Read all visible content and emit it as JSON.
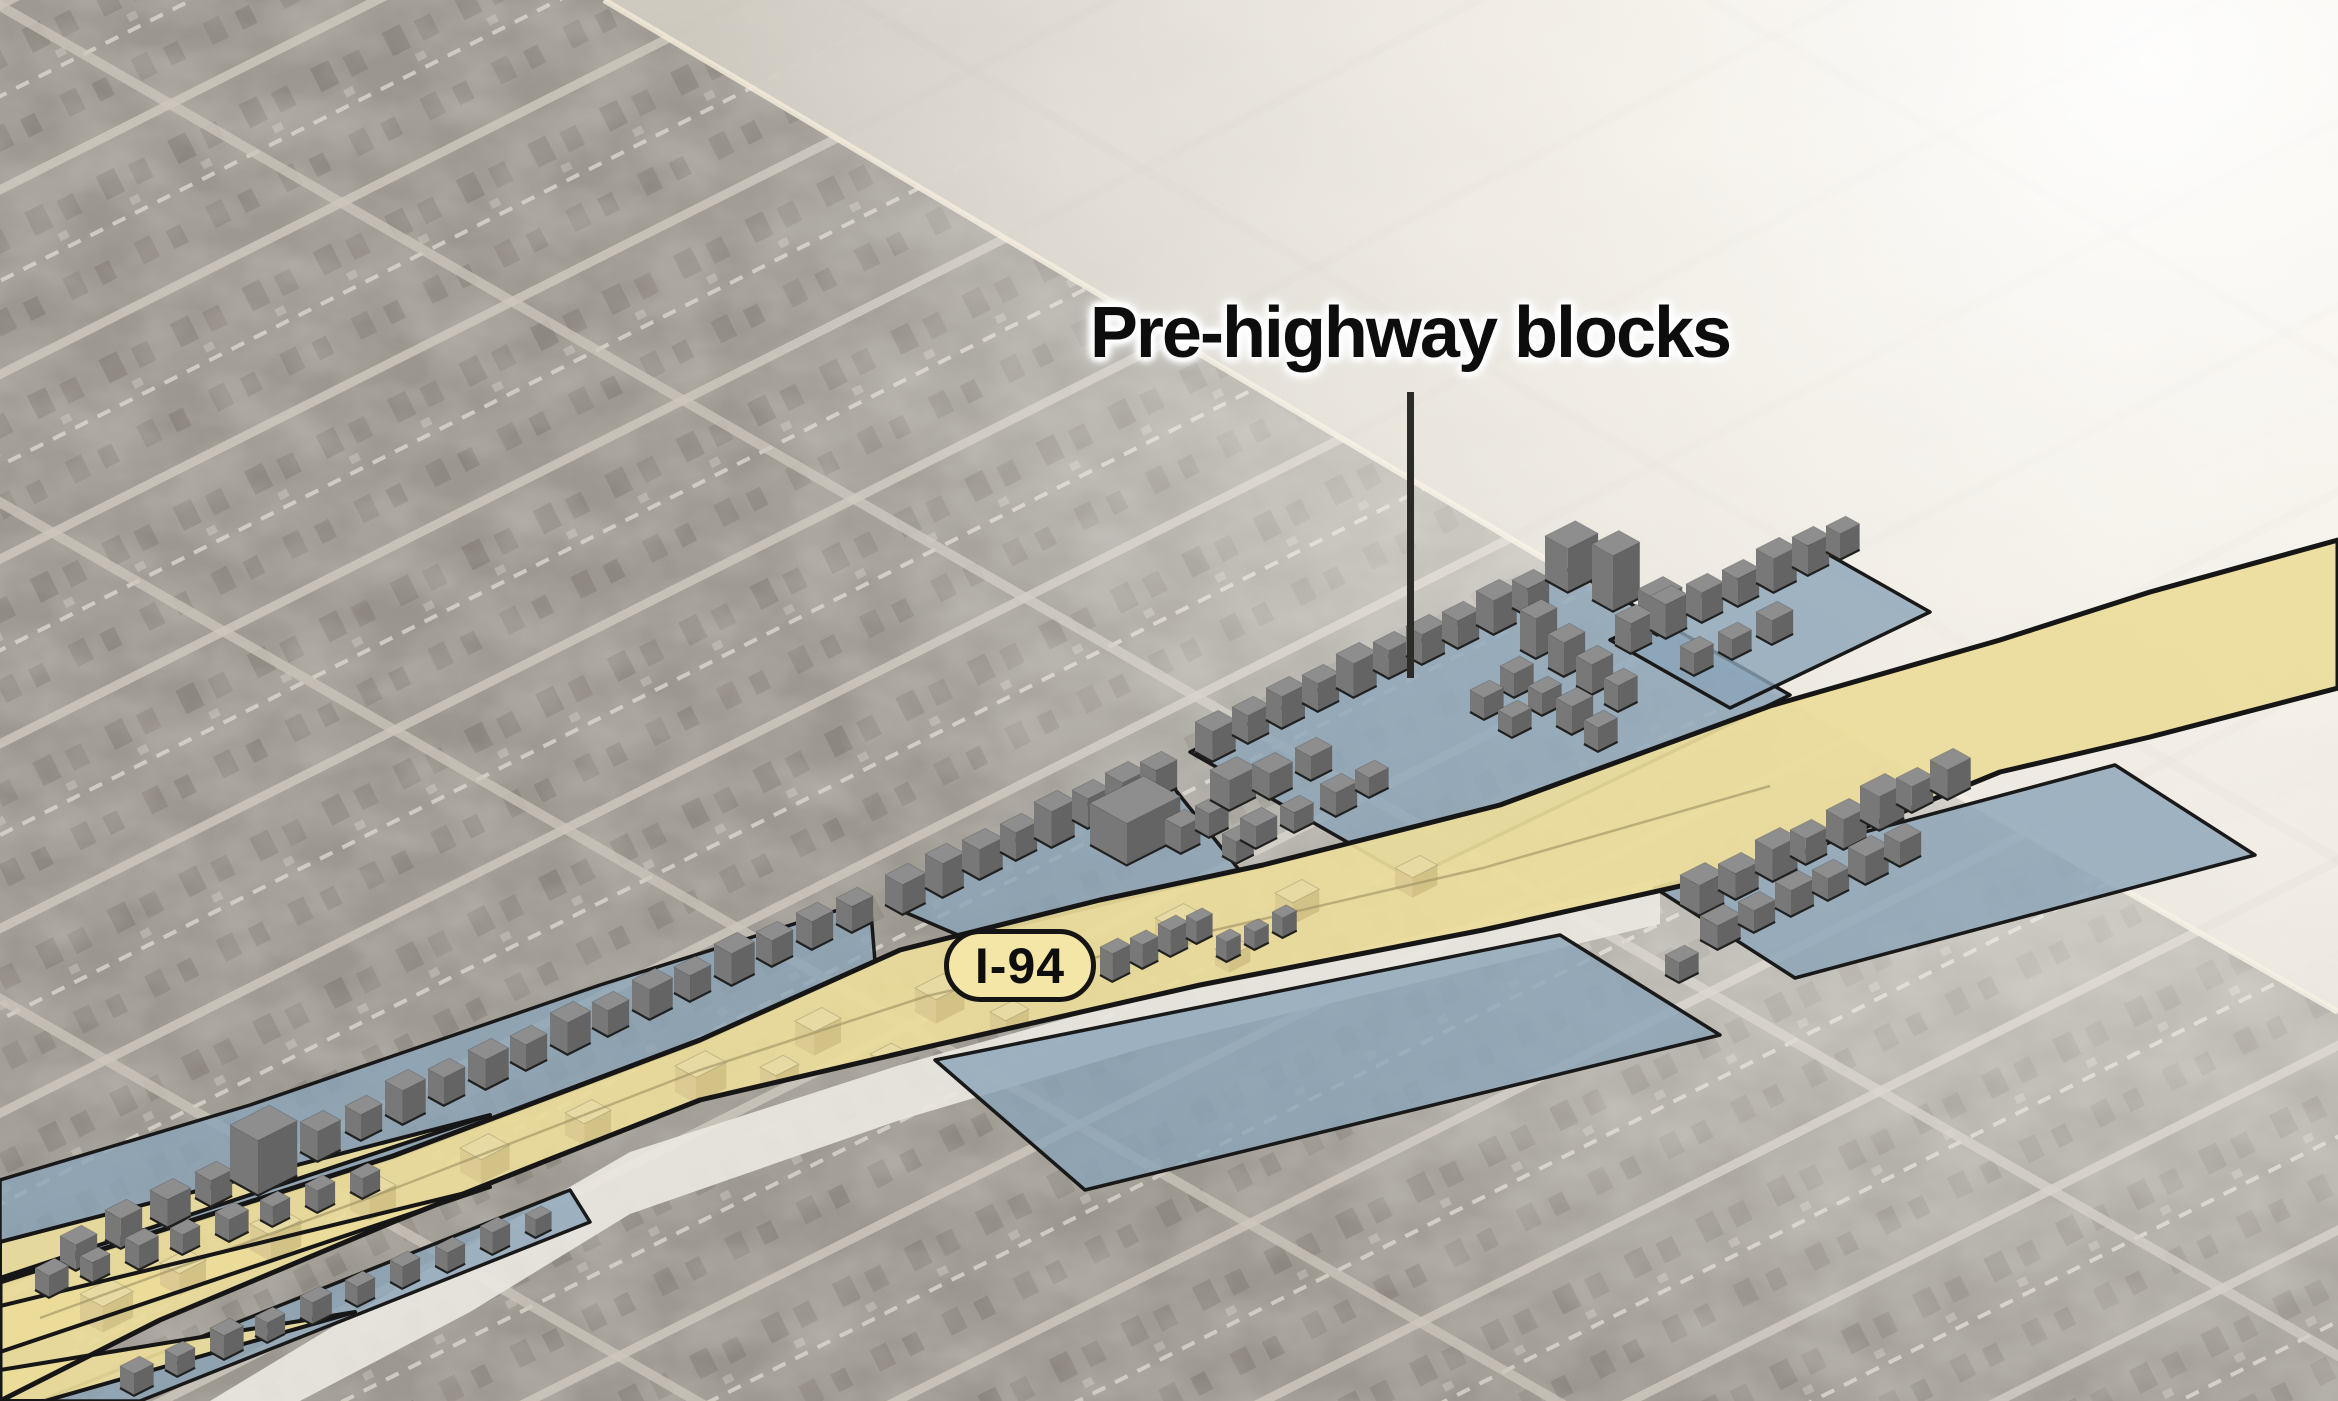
{
  "scene": {
    "width": 2338,
    "height": 1401
  },
  "annotation": {
    "label": "Pre-highway blocks"
  },
  "badge": {
    "label": "I-94"
  },
  "colors": {
    "highway_fill": "#ecdc9a",
    "highway_outline": "#161616",
    "block_overlay": "#8ba4b8",
    "block_outline": "#191919",
    "building_top": "#8e8e8e",
    "building_side": "#787878",
    "building_front": "#646464",
    "building_edge": "#20201f",
    "ghost_top": "#e8daa3",
    "ghost_side": "#dbcb92",
    "ghost_front": "#d2c286",
    "white_road": "#eae7e1",
    "aerial_dark": "#99948c",
    "aerial_light": "#e8e2d8",
    "boundary_road": "#f2e9d7",
    "centerline": "#9b8f63",
    "label_color": "#0d0d0d",
    "badge_fill": "#f4e6a6",
    "leader": "#2d2b28"
  },
  "map": {
    "dark_region": [
      [
        0,
        0
      ],
      [
        604,
        0
      ],
      [
        1560,
        568
      ],
      [
        2338,
        1012
      ],
      [
        2338,
        1401
      ],
      [
        0,
        1401
      ]
    ],
    "boundary_road": [
      [
        604,
        0
      ],
      [
        1560,
        568
      ],
      [
        2338,
        1012
      ]
    ],
    "white_road": [
      [
        210,
        1401
      ],
      [
        430,
        1268
      ],
      [
        630,
        1152
      ],
      [
        900,
        1065
      ],
      [
        1150,
        995
      ],
      [
        1420,
        935
      ],
      [
        1660,
        878
      ],
      [
        1660,
        924
      ],
      [
        1420,
        982
      ],
      [
        1150,
        1046
      ],
      [
        900,
        1120
      ],
      [
        630,
        1214
      ],
      [
        470,
        1312
      ],
      [
        300,
        1401
      ]
    ],
    "highway_top": [
      [
        0,
        1282
      ],
      [
        393,
        1156
      ],
      [
        700,
        1040
      ],
      [
        900,
        950
      ],
      [
        1100,
        900
      ],
      [
        1263,
        865
      ],
      [
        1500,
        805
      ],
      [
        1770,
        706
      ],
      [
        2000,
        640
      ],
      [
        2150,
        592
      ],
      [
        2338,
        540
      ]
    ],
    "highway_bottom": [
      [
        2338,
        688
      ],
      [
        2150,
        737
      ],
      [
        2000,
        772
      ],
      [
        1770,
        866
      ],
      [
        1483,
        930
      ],
      [
        1200,
        985
      ],
      [
        927,
        1047
      ],
      [
        700,
        1100
      ],
      [
        553,
        1158
      ],
      [
        393,
        1222
      ],
      [
        160,
        1320
      ],
      [
        0,
        1401
      ]
    ],
    "ramps": [
      [
        [
          0,
          1242
        ],
        [
          490,
          1115
        ],
        [
          0,
          1278
        ]
      ],
      [
        [
          490,
          1187
        ],
        [
          0,
          1306
        ],
        [
          0,
          1352
        ]
      ],
      [
        [
          355,
          1312
        ],
        [
          0,
          1370
        ],
        [
          0,
          1401
        ],
        [
          45,
          1401
        ]
      ]
    ],
    "centerline": [
      [
        40,
        1318
      ],
      [
        393,
        1189
      ],
      [
        700,
        1070
      ],
      [
        927,
        996
      ],
      [
        1263,
        919
      ],
      [
        1483,
        868
      ],
      [
        1770,
        786
      ]
    ],
    "blue_blocks": [
      [
        [
          0,
          1180
        ],
        [
          250,
          1105
        ],
        [
          600,
          985
        ],
        [
          870,
          900
        ],
        [
          875,
          962
        ],
        [
          700,
          1042
        ],
        [
          393,
          1158
        ],
        [
          0,
          1284
        ]
      ],
      [
        [
          888,
          905
        ],
        [
          1158,
          768
        ],
        [
          1240,
          871
        ],
        [
          965,
          938
        ]
      ],
      [
        [
          1190,
          752
        ],
        [
          1570,
          569
        ],
        [
          1790,
          695
        ],
        [
          1410,
          878
        ]
      ],
      [
        [
          1610,
          640
        ],
        [
          1810,
          544
        ],
        [
          1930,
          612
        ],
        [
          1730,
          708
        ]
      ],
      [
        [
          40,
          1401
        ],
        [
          570,
          1190
        ],
        [
          590,
          1222
        ],
        [
          140,
          1401
        ]
      ],
      [
        [
          935,
          1060
        ],
        [
          1560,
          935
        ],
        [
          1720,
          1035
        ],
        [
          1085,
          1190
        ]
      ],
      [
        [
          1655,
          888
        ],
        [
          2115,
          765
        ],
        [
          2255,
          855
        ],
        [
          1795,
          978
        ]
      ]
    ],
    "ghost_buildings": [
      [
        80,
        1320,
        34,
        26,
        26
      ],
      [
        160,
        1285,
        30,
        22,
        22
      ],
      [
        250,
        1250,
        34,
        24,
        26
      ],
      [
        350,
        1210,
        30,
        22,
        22
      ],
      [
        460,
        1172,
        32,
        24,
        24
      ],
      [
        565,
        1135,
        30,
        22,
        22
      ],
      [
        675,
        1092,
        34,
        24,
        26
      ],
      [
        795,
        1045,
        30,
        22,
        24
      ],
      [
        915,
        1012,
        32,
        24,
        24
      ],
      [
        1035,
        975,
        30,
        22,
        22
      ],
      [
        1155,
        942,
        32,
        22,
        24
      ],
      [
        1275,
        915,
        30,
        20,
        22
      ],
      [
        1395,
        888,
        28,
        20,
        20
      ],
      [
        520,
        1190,
        26,
        18,
        18
      ],
      [
        760,
        1085,
        26,
        18,
        18
      ],
      [
        990,
        1030,
        26,
        18,
        18
      ],
      [
        1215,
        965,
        24,
        16,
        16
      ],
      [
        620,
        1165,
        24,
        16,
        16
      ],
      [
        870,
        1070,
        24,
        16,
        16
      ]
    ],
    "buildings": [
      [
        60,
        1262,
        24,
        18,
        26
      ],
      [
        105,
        1240,
        24,
        18,
        30
      ],
      [
        150,
        1218,
        26,
        20,
        28
      ],
      [
        195,
        1198,
        24,
        18,
        26
      ],
      [
        230,
        1180,
        44,
        32,
        55
      ],
      [
        300,
        1152,
        26,
        20,
        30
      ],
      [
        345,
        1132,
        24,
        18,
        26
      ],
      [
        385,
        1115,
        26,
        20,
        34
      ],
      [
        428,
        1097,
        24,
        18,
        28
      ],
      [
        468,
        1080,
        26,
        20,
        30
      ],
      [
        510,
        1062,
        24,
        18,
        26
      ],
      [
        550,
        1045,
        26,
        20,
        32
      ],
      [
        592,
        1028,
        24,
        18,
        26
      ],
      [
        632,
        1010,
        26,
        20,
        30
      ],
      [
        674,
        993,
        24,
        18,
        26
      ],
      [
        714,
        976,
        26,
        20,
        32
      ],
      [
        756,
        958,
        24,
        18,
        26
      ],
      [
        796,
        941,
        24,
        18,
        28
      ],
      [
        836,
        924,
        24,
        18,
        26
      ],
      [
        35,
        1290,
        22,
        16,
        22
      ],
      [
        80,
        1276,
        20,
        14,
        20
      ],
      [
        125,
        1262,
        22,
        16,
        24
      ],
      [
        170,
        1248,
        20,
        14,
        20
      ],
      [
        215,
        1234,
        22,
        16,
        22
      ],
      [
        260,
        1220,
        20,
        14,
        20
      ],
      [
        305,
        1206,
        20,
        14,
        22
      ],
      [
        350,
        1192,
        20,
        14,
        20
      ],
      [
        885,
        905,
        26,
        20,
        30
      ],
      [
        925,
        888,
        24,
        20,
        34
      ],
      [
        962,
        870,
        26,
        20,
        30
      ],
      [
        1000,
        852,
        24,
        18,
        28
      ],
      [
        1034,
        838,
        26,
        20,
        36
      ],
      [
        1072,
        820,
        24,
        18,
        30
      ],
      [
        1105,
        805,
        26,
        20,
        32
      ],
      [
        1140,
        790,
        24,
        18,
        28
      ],
      [
        1090,
        845,
        60,
        42,
        42
      ],
      [
        1165,
        845,
        22,
        18,
        26
      ],
      [
        1195,
        830,
        22,
        16,
        24
      ],
      [
        1222,
        856,
        20,
        16,
        22
      ],
      [
        1195,
        752,
        26,
        20,
        30
      ],
      [
        1232,
        735,
        24,
        18,
        28
      ],
      [
        1266,
        720,
        26,
        18,
        32
      ],
      [
        1302,
        703,
        24,
        18,
        28
      ],
      [
        1336,
        688,
        26,
        20,
        34
      ],
      [
        1373,
        670,
        24,
        18,
        28
      ],
      [
        1406,
        656,
        26,
        18,
        30
      ],
      [
        1442,
        640,
        24,
        18,
        28
      ],
      [
        1476,
        625,
        26,
        20,
        34
      ],
      [
        1512,
        608,
        24,
        18,
        28
      ],
      [
        1545,
        580,
        34,
        26,
        44
      ],
      [
        1592,
        600,
        30,
        24,
        56
      ],
      [
        1638,
        625,
        28,
        22,
        36
      ],
      [
        1210,
        800,
        30,
        22,
        30
      ],
      [
        1252,
        790,
        26,
        20,
        26
      ],
      [
        1295,
        772,
        24,
        18,
        24
      ],
      [
        1240,
        840,
        24,
        18,
        22
      ],
      [
        1280,
        825,
        22,
        16,
        20
      ],
      [
        1320,
        808,
        24,
        18,
        24
      ],
      [
        1355,
        790,
        22,
        16,
        20
      ],
      [
        1520,
        650,
        24,
        18,
        40
      ],
      [
        1548,
        668,
        24,
        18,
        34
      ],
      [
        1576,
        686,
        24,
        18,
        30
      ],
      [
        1604,
        704,
        22,
        16,
        26
      ],
      [
        1500,
        690,
        22,
        16,
        24
      ],
      [
        1528,
        708,
        22,
        16,
        22
      ],
      [
        1556,
        726,
        24,
        18,
        28
      ],
      [
        1584,
        744,
        22,
        16,
        24
      ],
      [
        1470,
        712,
        22,
        16,
        22
      ],
      [
        1498,
        730,
        22,
        16,
        20
      ],
      [
        1615,
        645,
        24,
        18,
        30
      ],
      [
        1650,
        630,
        24,
        18,
        34
      ],
      [
        1686,
        614,
        24,
        18,
        30
      ],
      [
        1722,
        598,
        24,
        18,
        28
      ],
      [
        1756,
        583,
        26,
        20,
        34
      ],
      [
        1792,
        567,
        24,
        18,
        30
      ],
      [
        1826,
        552,
        22,
        16,
        26
      ],
      [
        1680,
        668,
        22,
        16,
        22
      ],
      [
        1718,
        652,
        22,
        16,
        20
      ],
      [
        1756,
        636,
        24,
        18,
        24
      ],
      [
        1680,
        905,
        28,
        22,
        30
      ],
      [
        1718,
        890,
        26,
        20,
        26
      ],
      [
        1755,
        872,
        28,
        20,
        32
      ],
      [
        1790,
        856,
        24,
        18,
        26
      ],
      [
        1826,
        840,
        26,
        20,
        30
      ],
      [
        1700,
        940,
        26,
        20,
        24
      ],
      [
        1738,
        924,
        24,
        18,
        22
      ],
      [
        1775,
        908,
        26,
        18,
        26
      ],
      [
        1812,
        892,
        24,
        18,
        22
      ],
      [
        1848,
        875,
        26,
        20,
        28
      ],
      [
        1884,
        858,
        24,
        18,
        24
      ],
      [
        1860,
        820,
        28,
        22,
        34
      ],
      [
        1896,
        804,
        24,
        18,
        26
      ],
      [
        1930,
        790,
        26,
        20,
        30
      ],
      [
        1665,
        975,
        22,
        16,
        20
      ],
      [
        1100,
        975,
        20,
        14,
        28
      ],
      [
        1130,
        962,
        18,
        14,
        24
      ],
      [
        1158,
        950,
        20,
        14,
        26
      ],
      [
        1186,
        938,
        18,
        12,
        22
      ],
      [
        1216,
        956,
        16,
        12,
        20
      ],
      [
        1244,
        944,
        16,
        12,
        18
      ],
      [
        1272,
        932,
        16,
        12,
        20
      ],
      [
        120,
        1388,
        22,
        16,
        22
      ],
      [
        165,
        1370,
        20,
        14,
        20
      ],
      [
        210,
        1352,
        22,
        16,
        24
      ],
      [
        255,
        1336,
        20,
        14,
        20
      ],
      [
        300,
        1318,
        22,
        14,
        22
      ],
      [
        345,
        1300,
        20,
        14,
        20
      ],
      [
        390,
        1282,
        20,
        14,
        22
      ],
      [
        435,
        1266,
        20,
        14,
        20
      ],
      [
        480,
        1248,
        20,
        14,
        22
      ],
      [
        525,
        1232,
        18,
        12,
        18
      ]
    ]
  }
}
